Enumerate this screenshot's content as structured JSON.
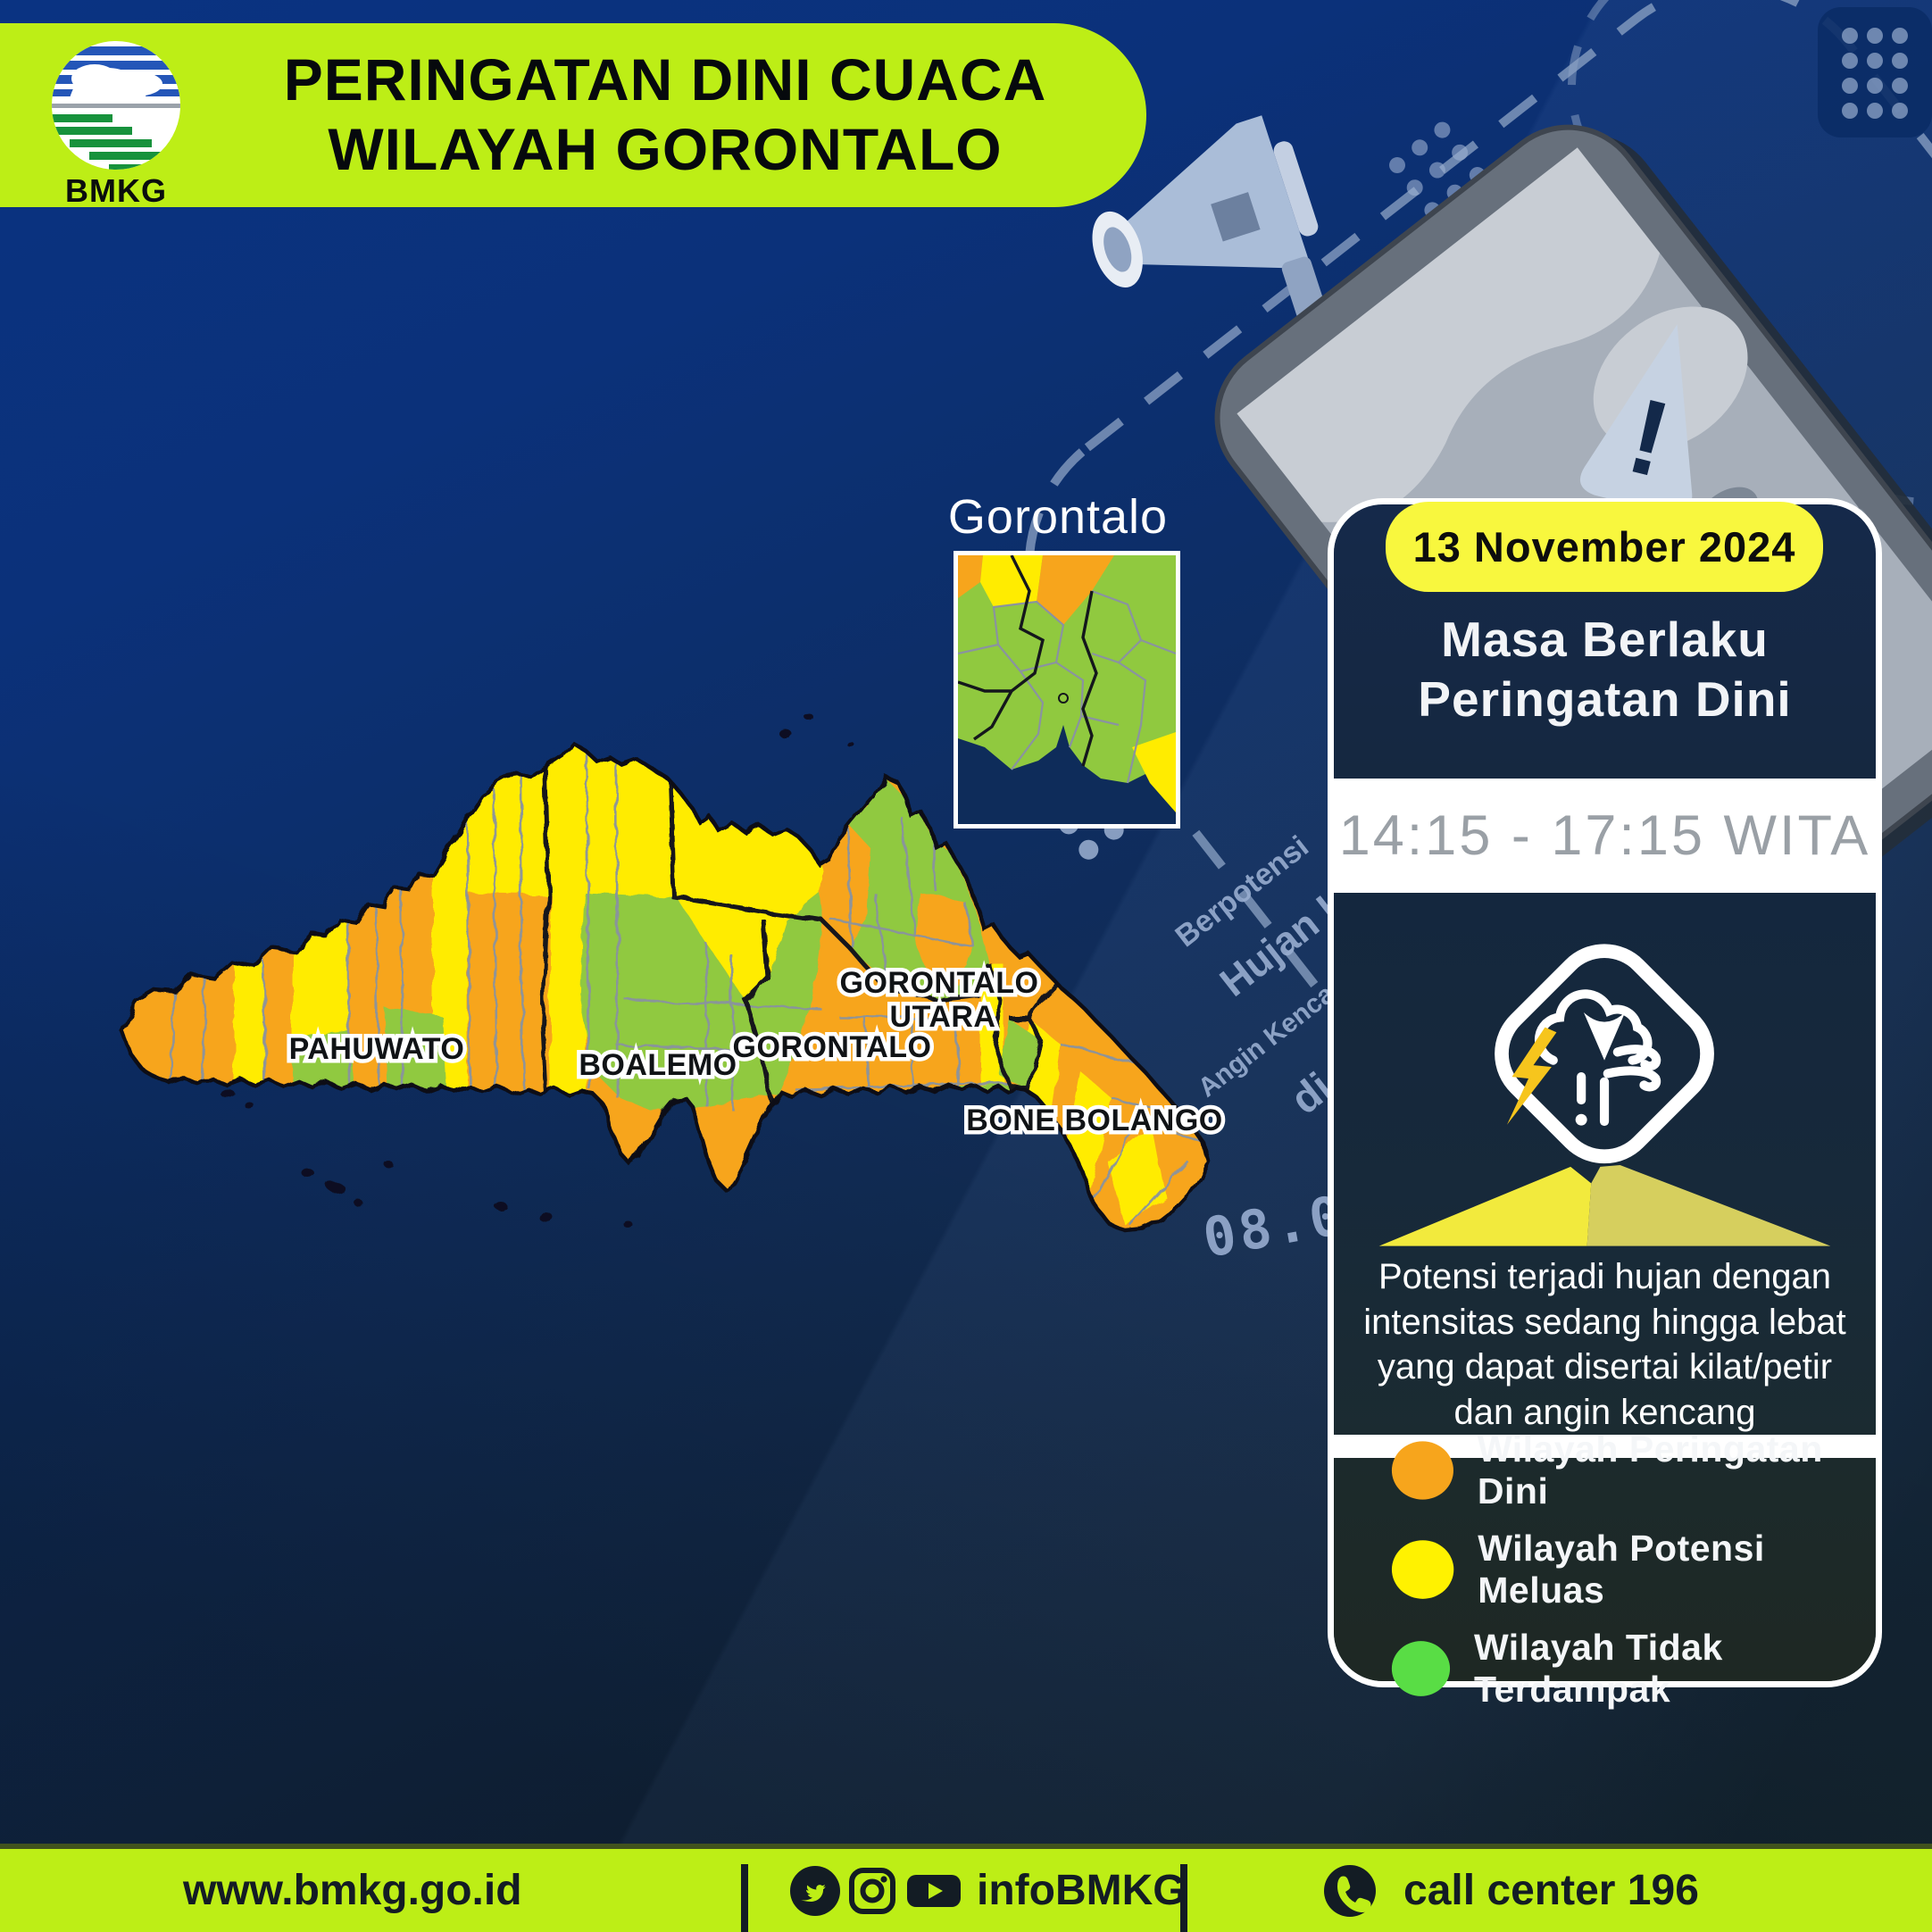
{
  "header": {
    "title_line1": "PERINGATAN DINI CUACA",
    "title_line2": "WILAYAH GORONTALO",
    "logo_text": "BMKG"
  },
  "decor": {
    "berpotensi": "Berpotensi",
    "hujan_lebat": "Hujan Lebat",
    "angin_kencang": "Angin Kencang",
    "di_wilayah": "di wilayah",
    "clock": "08.00",
    "clock2": "11.00",
    "warning_mark": "!"
  },
  "inset": {
    "label": "Gorontalo"
  },
  "map": {
    "labels": {
      "pahuwato": "PAHUWATO",
      "boalemo": "BOALEMO",
      "gorontalo": "GORONTALO",
      "gorontalo_utara_1": "GORONTALO",
      "gorontalo_utara_2": "UTARA",
      "bone_bolango": "BONE BOLANGO"
    },
    "colors": {
      "warning_orange": "#F7A51C",
      "potential_yellow": "#FFEC00",
      "unaffected_green": "#90C93F"
    }
  },
  "card": {
    "date": "13 November 2024",
    "validity_line1": "Masa Berlaku",
    "validity_line2": "Peringatan Dini",
    "time_range": "14:15 - 17:15 WITA",
    "description": "Potensi terjadi hujan dengan intensitas sedang hingga lebat yang dapat disertai kilat/petir dan angin kencang"
  },
  "legend": {
    "items": [
      {
        "label": "Wilayah Peringatan Dini",
        "color": "#F7A51C"
      },
      {
        "label": "Wilayah Potensi Meluas",
        "color": "#FFF200"
      },
      {
        "label": "Wilayah Tidak Terdampak",
        "color": "#59DD45"
      }
    ]
  },
  "footer": {
    "website": "www.bmkg.go.id",
    "social_handle": "infoBMKG",
    "call_center": "call center 196"
  }
}
